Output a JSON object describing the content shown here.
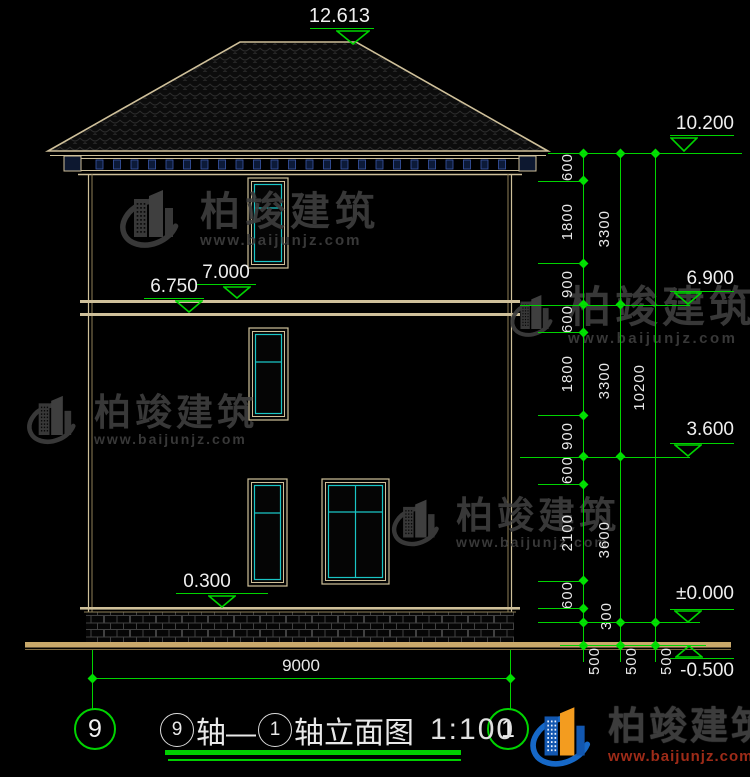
{
  "drawing_title": {
    "axis_start": "9",
    "mid": "轴—",
    "axis_end": "1",
    "suffix": "轴立面图",
    "scale": "1:100"
  },
  "axis_bubbles": {
    "left": "9",
    "right": "1"
  },
  "elevation_markers": [
    {
      "id": "ridge",
      "value": "12.613"
    },
    {
      "id": "eave",
      "value": "10.200"
    },
    {
      "id": "f7000",
      "value": "7.000"
    },
    {
      "id": "f6750",
      "value": "6.750"
    },
    {
      "id": "f6900",
      "value": "6.900"
    },
    {
      "id": "f3600",
      "value": "3.600"
    },
    {
      "id": "f0300",
      "value": "0.300"
    },
    {
      "id": "zero",
      "value": "±0.000"
    },
    {
      "id": "ground",
      "value": "-0.500"
    }
  ],
  "dimensions": {
    "right_columns": [
      {
        "name": "inner",
        "segments_mm": [
          600,
          1800,
          900,
          600,
          1800,
          900,
          600,
          2100,
          600,
          300,
          500
        ]
      },
      {
        "name": "middle",
        "segments_mm": [
          3300,
          3300,
          3600,
          500
        ]
      },
      {
        "name": "outer",
        "segments_mm": [
          10200,
          500
        ]
      }
    ],
    "bottom_width": "9000"
  },
  "watermark": {
    "brand": "柏竣建筑",
    "site": "www.baijunjz.com"
  },
  "footer_logo": {
    "brand": "柏竣建筑",
    "site": "www.baijunjz.com"
  }
}
